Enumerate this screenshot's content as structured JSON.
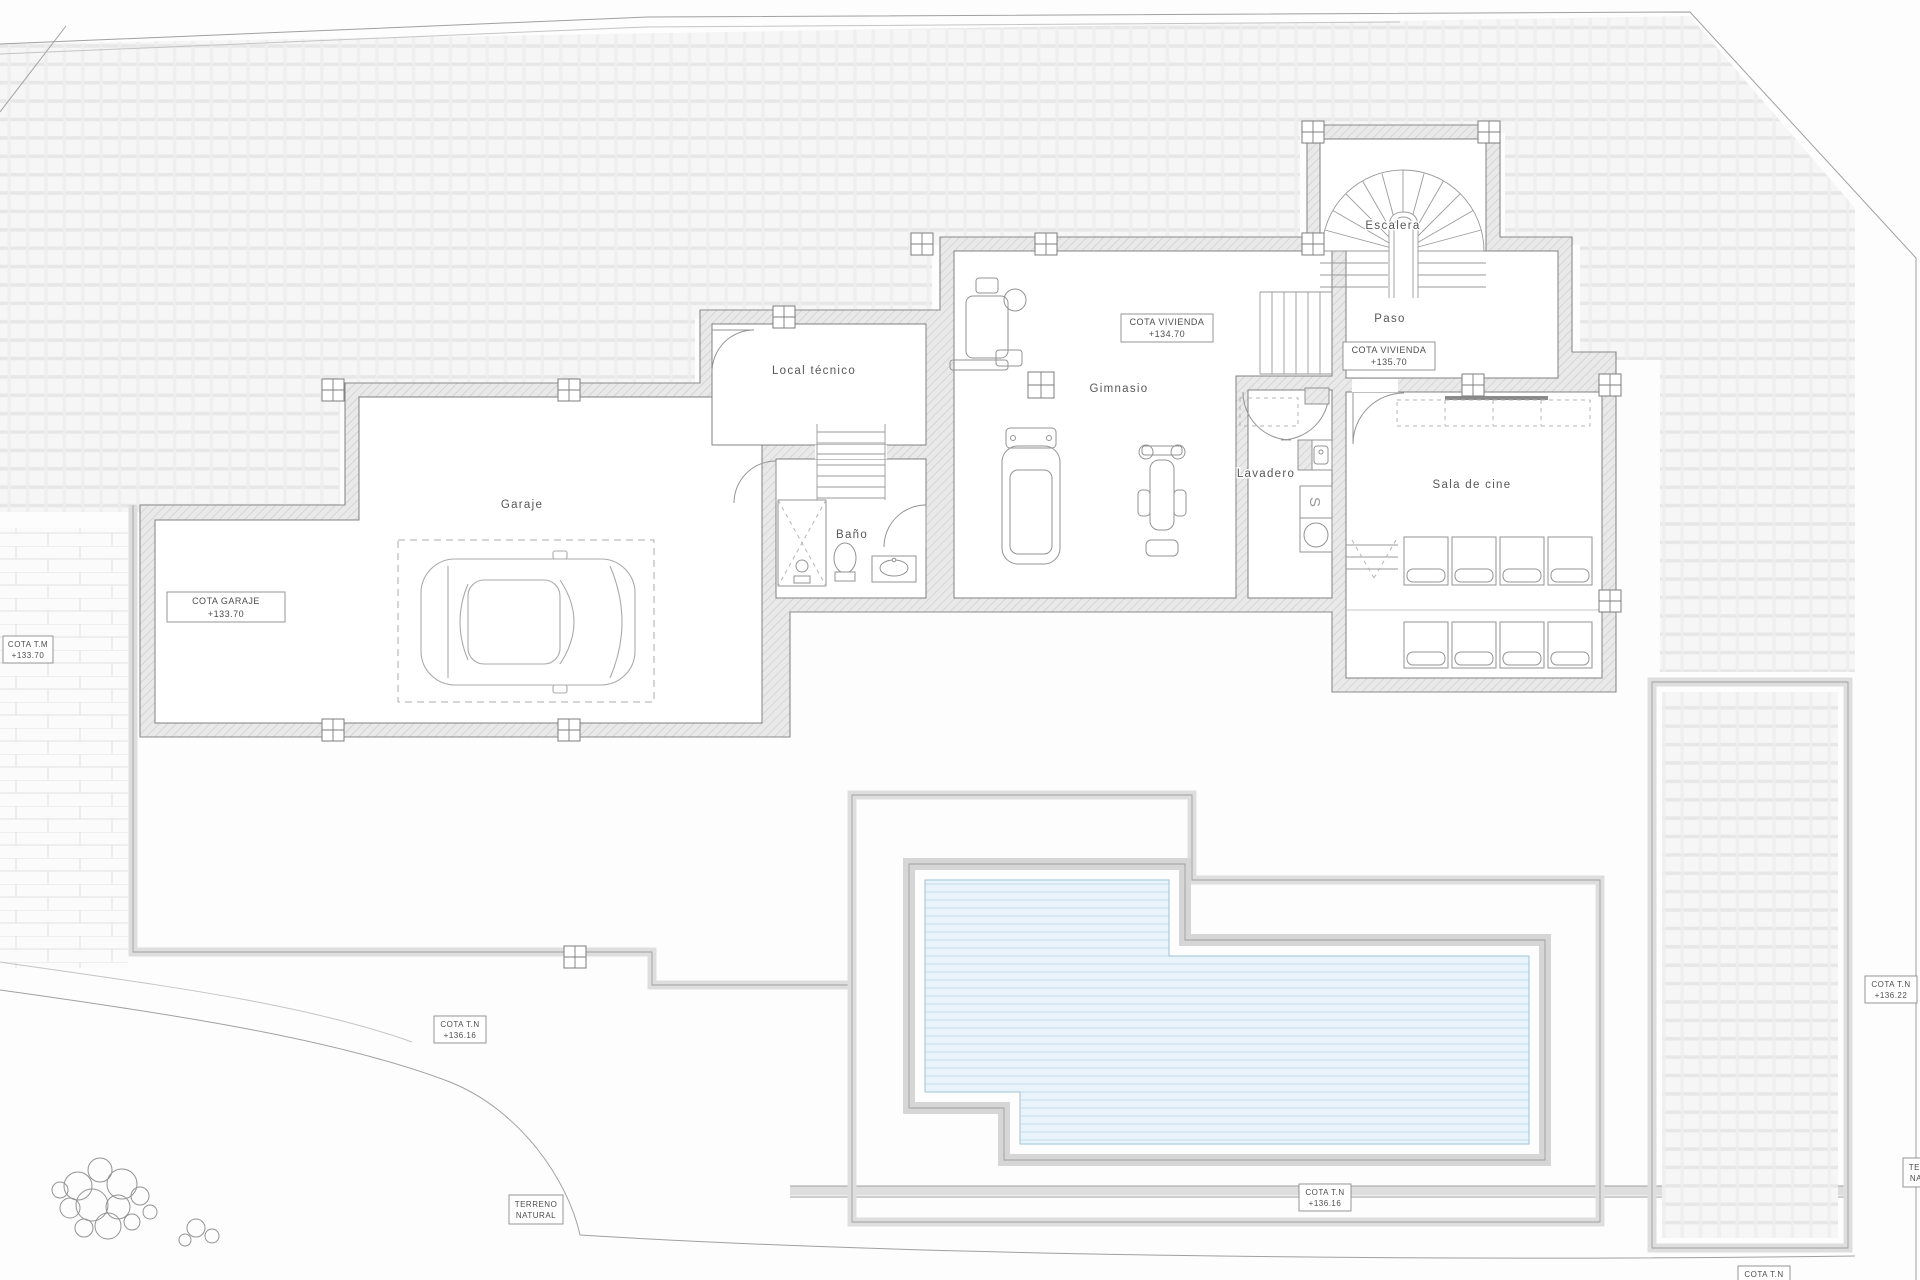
{
  "drawing": {
    "rooms": [
      {
        "id": "garaje",
        "label": "Garaje"
      },
      {
        "id": "local-tecnico",
        "label": "Local técnico"
      },
      {
        "id": "bano",
        "label": "Baño"
      },
      {
        "id": "gimnasio",
        "label": "Gimnasio"
      },
      {
        "id": "lavadero",
        "label": "Lavadero"
      },
      {
        "id": "paso",
        "label": "Paso"
      },
      {
        "id": "escalera",
        "label": "Escalera"
      },
      {
        "id": "sala-de-cine",
        "label": "Sala de cine"
      }
    ],
    "levels": [
      {
        "id": "cota-garaje",
        "name": "COTA GARAJE",
        "value": "+133.70"
      },
      {
        "id": "cota-vivienda-gimnasio",
        "name": "COTA VIVIENDA",
        "value": "+134.70"
      },
      {
        "id": "cota-vivienda-paso",
        "name": "COTA VIVIENDA",
        "value": "+135.70"
      },
      {
        "id": "cota-tm-muro",
        "name": "COTA T.M",
        "value": "+133.70"
      },
      {
        "id": "cota-tn-terraza",
        "name": "COTA T.N",
        "value": "+136.16"
      },
      {
        "id": "cota-tn-piscina",
        "name": "COTA T.N",
        "value": "+136.16"
      },
      {
        "id": "cota-tn-este",
        "name": "COTA T.N",
        "value": "+136.22"
      },
      {
        "id": "cota-tn-borde-inferior",
        "name": "COTA T.N",
        "value": ""
      }
    ],
    "site_labels": [
      {
        "id": "terreno-natural-oeste",
        "line1": "TERRENO",
        "line2": "NATURAL"
      },
      {
        "id": "terreno-natural-este",
        "line1": "TERRENO",
        "line2": "NATURAL"
      }
    ],
    "fixtures": {
      "dryer_letter": "S"
    },
    "colors": {
      "paper": "#fdfdfd",
      "line": "#8a8a8a",
      "wall_fill": "#e9e9e9",
      "terrace_band": "#dedede",
      "water": "#e8f4fa",
      "water_line": "#c3ddea",
      "label_text": "#575757"
    }
  }
}
